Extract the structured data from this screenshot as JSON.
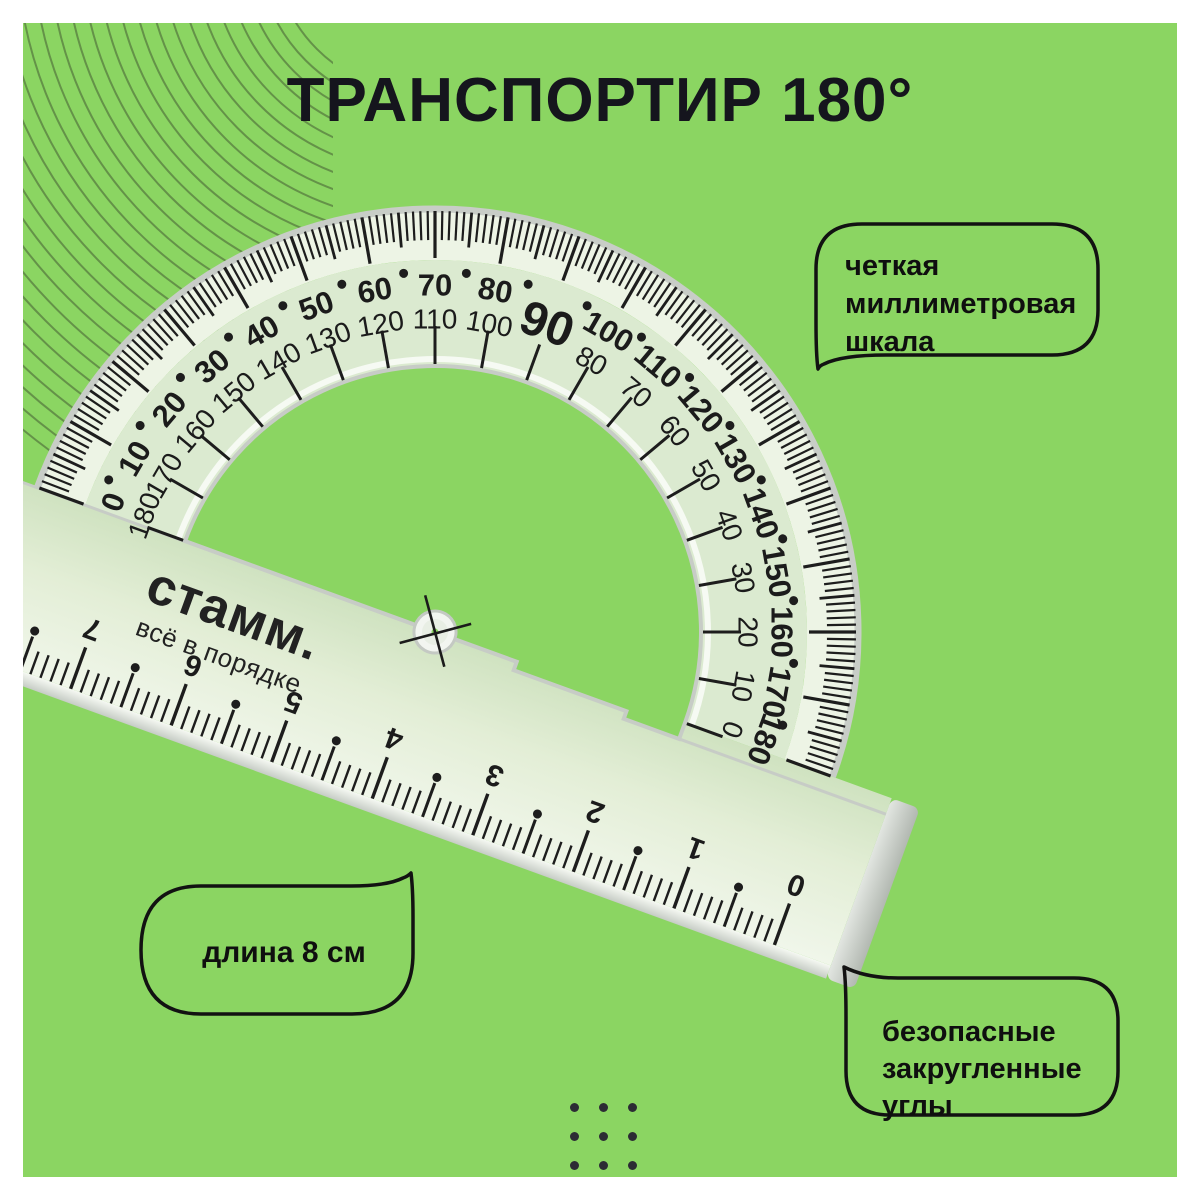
{
  "title": "ТРАНСПОРТИР 180°",
  "colors": {
    "background": "#8BD562",
    "ink": "#1d1d1d",
    "plastic_tint": "#dbead0",
    "edge_silver": "#c7ccc6"
  },
  "callouts": {
    "mm_scale": {
      "lines": [
        "четкая",
        "миллиметровая",
        "шкала"
      ]
    },
    "length": {
      "text": "длина 8 см"
    },
    "safe_corners": {
      "lines": [
        "безопасные",
        "закругленные",
        "углы"
      ]
    }
  },
  "protractor": {
    "brand": "стамм.",
    "brand_tagline": "всё в порядке",
    "rotation_deg": 20,
    "apex_label": "90",
    "degree_labels_outer": [
      0,
      10,
      20,
      30,
      40,
      50,
      60,
      70,
      80,
      90,
      100,
      110,
      120,
      130,
      140,
      150,
      160,
      170,
      180
    ],
    "degree_labels_inner": [
      180,
      170,
      160,
      150,
      140,
      130,
      120,
      110,
      100,
      90,
      80,
      70,
      60,
      50,
      40,
      30,
      20,
      10,
      0
    ],
    "ruler_cm_labels": [
      "0",
      "1",
      "2",
      "3",
      "4",
      "5",
      "6",
      "7",
      "8"
    ],
    "ruler_length_cm": 8
  }
}
